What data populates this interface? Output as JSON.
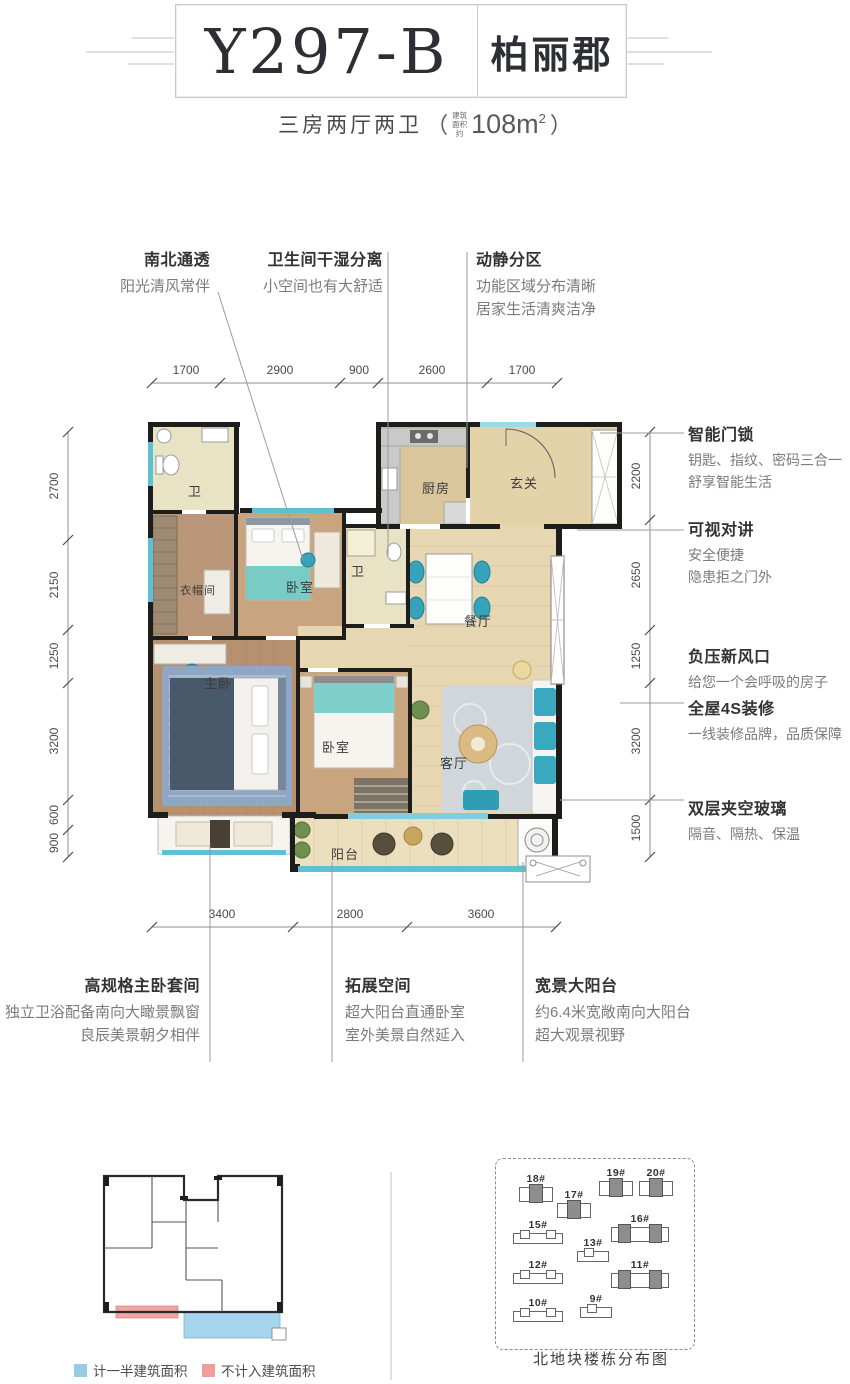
{
  "header": {
    "model": "Y297-B",
    "name": "柏丽郡"
  },
  "subtitle": {
    "layout": "三房两厅两卫",
    "paren_open": "（",
    "area_note": "建筑\n面积\n约",
    "area": "108m",
    "area_sup": "2",
    "paren_close": "）"
  },
  "features": {
    "top": [
      {
        "title": "南北通透",
        "lines": [
          "阳光清风常伴"
        ]
      },
      {
        "title": "卫生间干湿分离",
        "lines": [
          "小空间也有大舒适"
        ]
      },
      {
        "title": "动静分区",
        "lines": [
          "功能区域分布清晰",
          "居家生活清爽洁净"
        ]
      }
    ],
    "right": [
      {
        "title": "智能门锁",
        "lines": [
          "钥匙、指纹、密码三合一",
          "舒享智能生活"
        ]
      },
      {
        "title": "可视对讲",
        "lines": [
          "安全便捷",
          "隐患拒之门外"
        ]
      },
      {
        "title": "负压新风口",
        "lines": [
          "给您一个会呼吸的房子"
        ]
      },
      {
        "title": "全屋4S装修",
        "lines": [
          "一线装修品牌，品质保障"
        ]
      },
      {
        "title": "双层夹空玻璃",
        "lines": [
          "隔音、隔热、保温"
        ]
      }
    ],
    "bottom": [
      {
        "title": "高规格主卧套间",
        "lines": [
          "独立卫浴配备南向大瞰景飘窗",
          "良辰美景朝夕相伴"
        ]
      },
      {
        "title": "拓展空间",
        "lines": [
          "超大阳台直通卧室",
          "室外美景自然延入"
        ]
      },
      {
        "title": "宽景大阳台",
        "lines": [
          "约6.4米宽敞南向大阳台",
          "超大观景视野"
        ]
      }
    ]
  },
  "dims": {
    "top": [
      "1700",
      "2900",
      "900",
      "2600",
      "1700"
    ],
    "left": [
      "2700",
      "2150",
      "1250",
      "3200",
      "600",
      "900"
    ],
    "right": [
      "2200",
      "2650",
      "1250",
      "3200",
      "1500"
    ],
    "bottom": [
      "3400",
      "2800",
      "3600"
    ]
  },
  "plan": {
    "rooms": {
      "bath1": "卫",
      "closet": "衣帽间",
      "master": "主卧",
      "bedroom1": "卧室",
      "bath2": "卫",
      "kitchen": "厨房",
      "entry": "玄关",
      "dining": "餐厅",
      "living": "客厅",
      "bedroom2": "卧室",
      "balcony": "阳台"
    }
  },
  "legend": {
    "items": [
      {
        "label": "计一半建筑面积",
        "color": "#9cc9e4"
      },
      {
        "label": "不计入建筑面积",
        "color": "#ef9e9c"
      }
    ]
  },
  "siteplan": {
    "caption": "北地块楼栋分布图",
    "buildings": [
      {
        "label": "18#"
      },
      {
        "label": "17#"
      },
      {
        "label": "19#"
      },
      {
        "label": "20#"
      },
      {
        "label": "15#"
      },
      {
        "label": "16#"
      },
      {
        "label": "13#"
      },
      {
        "label": "12#"
      },
      {
        "label": "11#"
      },
      {
        "label": "10#"
      },
      {
        "label": "9#"
      }
    ]
  },
  "colors": {
    "wall": "#1d1d1b",
    "window_teal": "#5fc0d2",
    "accent_teal": "#36a3ba",
    "legend_blue": "#9cc9e4",
    "legend_pink": "#ef9e9c"
  }
}
